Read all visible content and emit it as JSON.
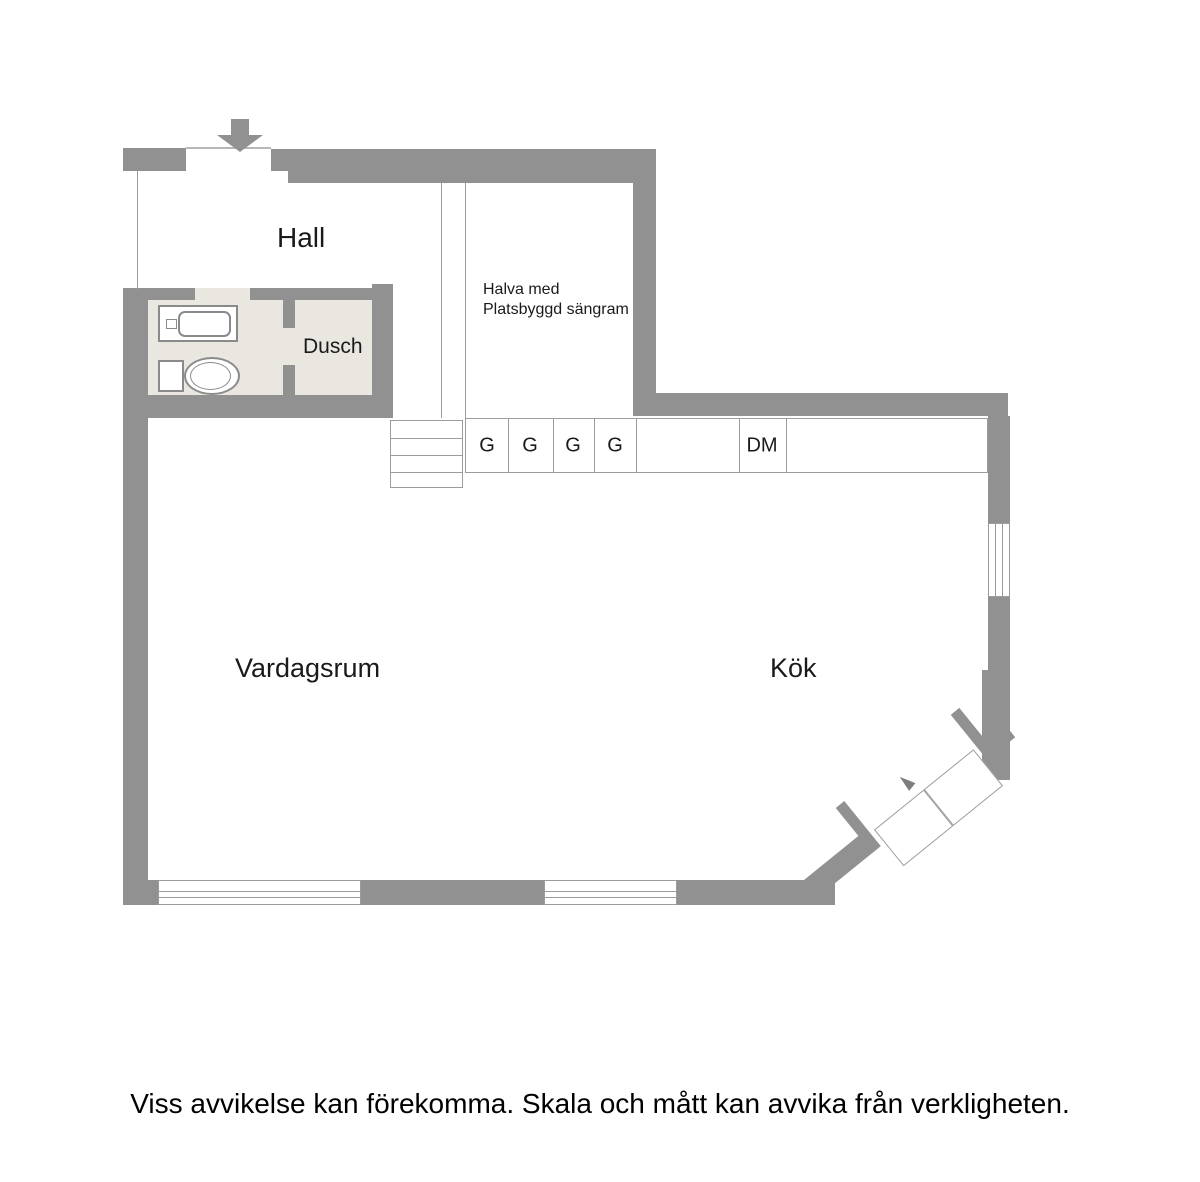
{
  "plan": {
    "rooms": {
      "hall": "Hall",
      "shower": "Dusch",
      "living_room": "Vardagsrum",
      "kitchen": "Kök",
      "alcove_note_line1": "Halva med",
      "alcove_note_line2": "Platsbyggd sängram"
    },
    "kitchen_cabinets": [
      {
        "label": "G"
      },
      {
        "label": "G"
      },
      {
        "label": "G"
      },
      {
        "label": "G"
      },
      {
        "label": ""
      },
      {
        "label": "DM"
      },
      {
        "label": ""
      }
    ]
  },
  "footer": {
    "disclaimer": "Viss avvikelse kan förekomma. Skala och mått kan avvika från verkligheten."
  },
  "colors": {
    "wall": "#919191",
    "bathroom_floor": "#eae7e1",
    "outline": "#9c9c9c",
    "text": "#1a1a1a",
    "canvas": "#ffffff"
  },
  "symbols": {
    "entrance_arrow": "entrance-arrow-icon",
    "toilet": "toilet-icon",
    "sink": "sink-icon",
    "stairs": "stairs-icon",
    "window": "window-symbol",
    "balcony_door": "double-door-symbol"
  }
}
